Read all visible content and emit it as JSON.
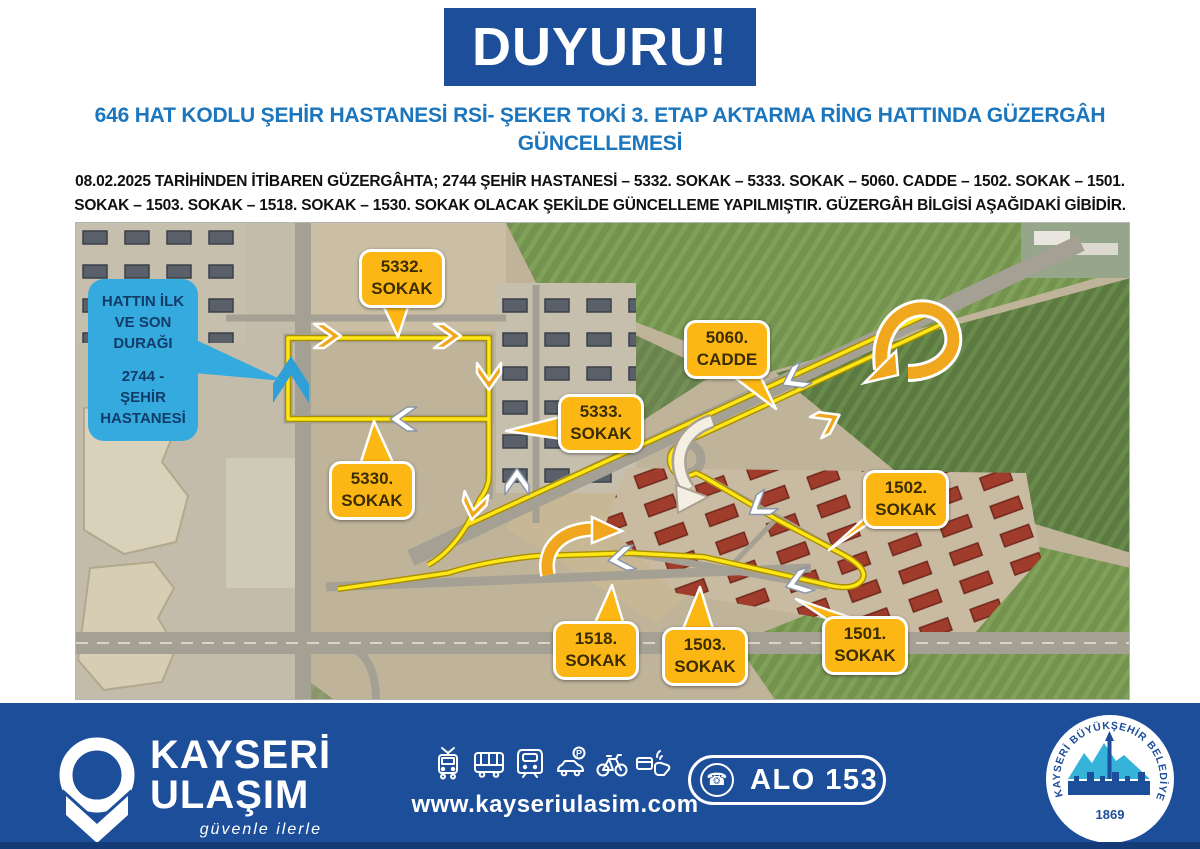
{
  "banner": {
    "title": "DUYURU!"
  },
  "heading": {
    "text": "646 HAT KODLU ŞEHİR HASTANESİ RSİ- ŞEKER TOKİ 3. ETAP AKTARMA RİNG HATTINDA GÜZERGÂH GÜNCELLEMESİ"
  },
  "intro": {
    "text": "08.02.2025 TARİHİNDEN İTİBAREN GÜZERGÂHTA; 2744 ŞEHİR HASTANESİ – 5332. SOKAK – 5333. SOKAK – 5060. CADDE – 1502. SOKAK – 1501. SOKAK – 1503. SOKAK – 1518. SOKAK – 1530. SOKAK OLACAK ŞEKİLDE GÜNCELLEME YAPILMIŞTIR. GÜZERGÂH BİLGİSİ AŞAĞIDAKİ GİBİDİR."
  },
  "map": {
    "terminal_callout": {
      "l1": "HATTIN İLK",
      "l2": "VE SON",
      "l3": "DURAĞI",
      "stop1": "2744 - ŞEHİR",
      "stop2": "HASTANESİ"
    },
    "labels": {
      "s5332": {
        "l1": "5332.",
        "l2": "SOKAK"
      },
      "s5060": {
        "l1": "5060.",
        "l2": "CADDE"
      },
      "s5333": {
        "l1": "5333.",
        "l2": "SOKAK"
      },
      "s5330": {
        "l1": "5330.",
        "l2": "SOKAK"
      },
      "s1502": {
        "l1": "1502.",
        "l2": "SOKAK"
      },
      "s1518": {
        "l1": "1518.",
        "l2": "SOKAK"
      },
      "s1503": {
        "l1": "1503.",
        "l2": "SOKAK"
      },
      "s1501": {
        "l1": "1501.",
        "l2": "SOKAK"
      }
    }
  },
  "footer": {
    "brand": {
      "name1": "KAYSERİ",
      "name2": "ULAŞIM",
      "tagline": "güvenle ilerle"
    },
    "icons": [
      "tram-icon",
      "bus-icon",
      "metro-icon",
      "car-parking-icon",
      "bicycle-icon",
      "contactless-card-icon"
    ],
    "website": "www.kayseriulasim.com",
    "phone": {
      "label": "ALO 153",
      "icon": "phone-icon",
      "glyph": "☎"
    },
    "seal": {
      "ring_text": "KAYSERİ BÜYÜKŞEHİR BELEDİYESİ",
      "year": "1869"
    }
  },
  "colors": {
    "banner_blue": "#1d4e9a",
    "heading_blue": "#1b76bd",
    "footer_blue": "#1d4e9a",
    "label_yellow": "#fdb714",
    "callout_blue": "#35aadf",
    "route_yellow": "#ffe619",
    "arrow_orange": "#f0a71e",
    "seal_cyan": "#36b3d9"
  }
}
